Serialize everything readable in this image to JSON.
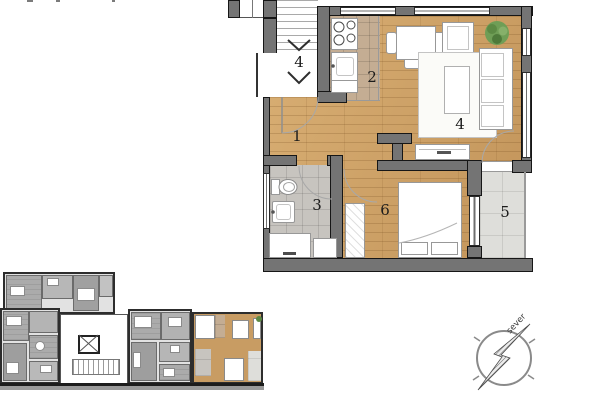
{
  "main_plan": {
    "rooms": [
      {
        "key": "hallway",
        "label": "1"
      },
      {
        "key": "kitchen",
        "label": "2"
      },
      {
        "key": "bathroom",
        "label": "3"
      },
      {
        "key": "living-room",
        "label": "4"
      },
      {
        "key": "terrace",
        "label": "5"
      },
      {
        "key": "bedroom",
        "label": "6"
      }
    ],
    "stairwell": {
      "floor_label": "4"
    }
  },
  "compass": {
    "north_label": "sever"
  },
  "colors": {
    "wood_floor": "#CDA267",
    "kitchen_tile": "#C4AD93",
    "bath_tile": "#C7C4BF",
    "terrace_tile": "#DEDEDA",
    "wall_fill": "#747474",
    "wall_outline": "#161616",
    "plant_green": "#5C8A44",
    "overview_room_gray": "#ABABAB",
    "highlight_wood": "#C89C63"
  }
}
